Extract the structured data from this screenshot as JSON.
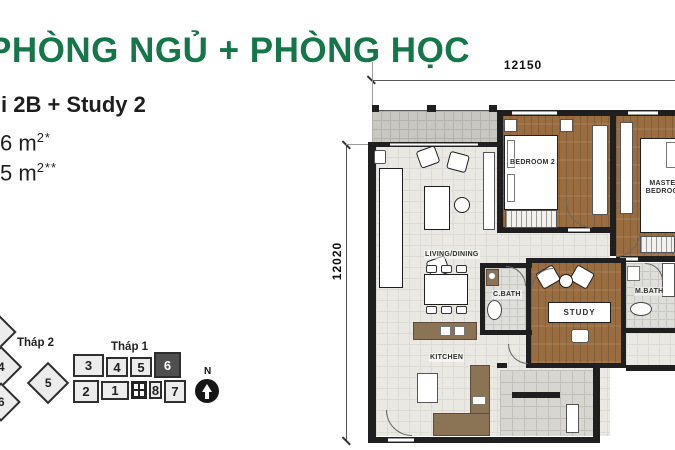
{
  "title": "PHÒNG NGỦ + PHÒNG HỌC",
  "info": {
    "unit_line": "i 2B + Study 2",
    "area1": {
      "main": "6 m",
      "sup": "2*"
    },
    "area2": {
      "main": "5 m",
      "sup": "2**"
    }
  },
  "keyplan": {
    "thap2_label": "Tháp 2",
    "thap1_label": "Tháp 1",
    "thap2_units": [
      "4",
      "5",
      "6"
    ],
    "thap1_top": [
      "3",
      "4",
      "5",
      "6"
    ],
    "thap1_bottom": [
      "2",
      "1",
      "8",
      "7"
    ],
    "highlighted_unit": "6",
    "compass_n": "N"
  },
  "plan": {
    "dim_width": "12150",
    "dim_height": "12020",
    "rooms": {
      "living": "LIVING/DINING",
      "kitchen": "KITCHEN",
      "bedroom2": "BEDROOM 2",
      "master": "MASTER BEDROOM",
      "study": "STUDY",
      "cbath": "C.BATH",
      "mbath": "M.BATH"
    }
  },
  "colors": {
    "accent_green": "#15764A",
    "wood": "#9A6D40",
    "wall": "#1F1F1F",
    "highlight_unit": "#4F4F4F"
  }
}
